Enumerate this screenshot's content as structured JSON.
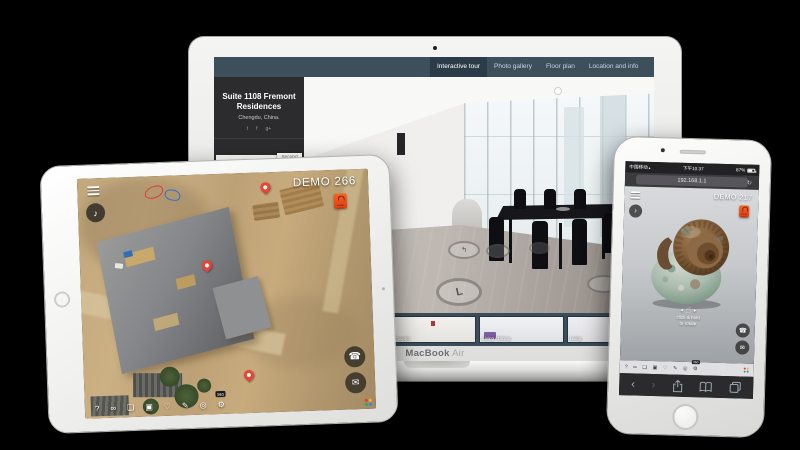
{
  "colors": {
    "background": "#000000",
    "navbar_slate": "#3e4f5c",
    "sidebar_dark": "#2c2c2e",
    "accent_red": "#e8432e",
    "pin_red": "#ea4335",
    "sofa_purple": "#7e5da0"
  },
  "toolbar_icons": [
    {
      "name": "help-icon",
      "glyph": "?"
    },
    {
      "name": "vr-goggles-icon",
      "glyph": "∞"
    },
    {
      "name": "gallery-icon",
      "glyph": "❏"
    },
    {
      "name": "camera-icon",
      "glyph": "▣"
    },
    {
      "name": "heart-icon",
      "glyph": "♡"
    },
    {
      "name": "annotate-icon",
      "glyph": "✎"
    },
    {
      "name": "info-icon",
      "glyph": "◎"
    },
    {
      "name": "settings-gear-icon",
      "glyph": "⚙"
    }
  ],
  "toolbar_badge": "360",
  "contact": {
    "phone_glyph": "☎",
    "mail_glyph": "✉",
    "music_glyph": "♪"
  },
  "macbook": {
    "label_primary": "MacBook",
    "label_secondary": "Air",
    "nav_tabs": [
      {
        "label": "Interactive tour",
        "active": true
      },
      {
        "label": "Photo gallery",
        "active": false
      },
      {
        "label": "Floor plan",
        "active": false
      },
      {
        "label": "Location and info",
        "active": false
      }
    ],
    "sidebar": {
      "title": "Suite 1108 Fremont Residences",
      "subtitle": "Chengdu, China.",
      "social": [
        {
          "name": "twitter-icon",
          "glyph": "t"
        },
        {
          "name": "facebook-icon",
          "glyph": "f"
        },
        {
          "name": "googleplus-icon",
          "glyph": "g+"
        }
      ],
      "floor_options": [
        {
          "label": "Second",
          "active": false
        },
        {
          "label": "Main",
          "active": true
        }
      ]
    },
    "rings": {
      "big_glyph": "L",
      "m1_glyph": "↰",
      "m2_glyph": "↶"
    },
    "thumbnails": [
      {
        "label": ""
      },
      {
        "label": "Entry"
      },
      {
        "label": "Powder"
      },
      {
        "label": "Living / Dining"
      },
      {
        "label": "Living"
      }
    ]
  },
  "ipad": {
    "demo_label": "DEMO 266"
  },
  "iphone": {
    "status": {
      "carrier": "中国移动",
      "wifi_glyph": "▴",
      "time": "下午10:37",
      "battery": "87%"
    },
    "url": "192.168.1.1",
    "refresh_glyph": "↻",
    "demo_label": "DEMO 217",
    "hint_arrow_left": "◄",
    "hint_hand_glyph": "☝",
    "hint_arrow_right": "►",
    "hint_line1": "click & hold",
    "hint_line2": "to rotate",
    "safari": {
      "back_glyph": "‹",
      "forward_glyph": "›"
    }
  }
}
